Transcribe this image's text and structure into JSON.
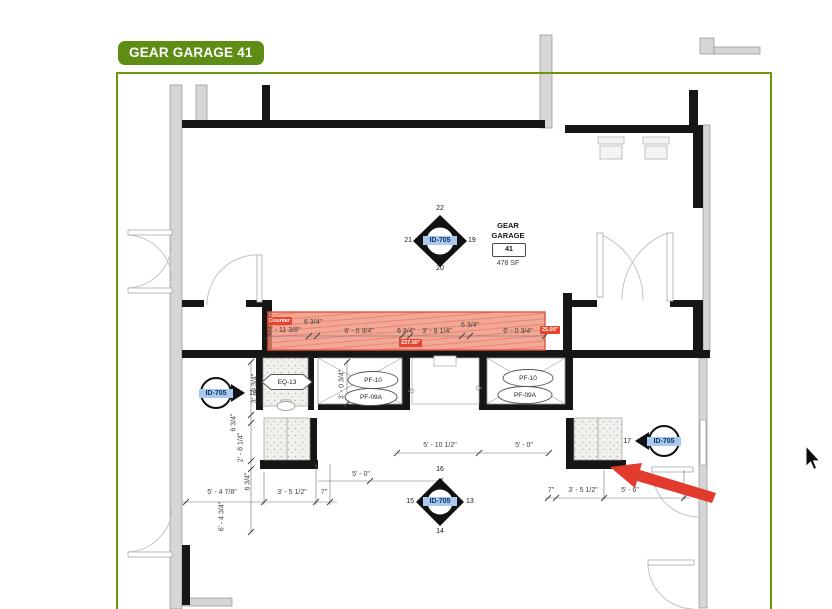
{
  "tag_label": "GEAR GARAGE 41",
  "room": {
    "name_line1": "GEAR",
    "name_line2": "GARAGE",
    "number": "41",
    "area": "478 SF"
  },
  "keynotes": {
    "center": {
      "id": "ID-705",
      "n_top": "22",
      "n_left": "21",
      "n_right": "19",
      "n_bottom": "20"
    },
    "bottom": {
      "id": "ID-705",
      "n_top": "16",
      "n_left": "15",
      "n_right": "13",
      "n_bottom": "14"
    },
    "left": {
      "id": "ID-705",
      "number": "18"
    },
    "right": {
      "id": "ID-705",
      "number": "17"
    }
  },
  "equipment_tags": {
    "eq": "EQ-13",
    "pf_left_top": "PF-10",
    "pf_left_bottom": "PF-09A",
    "pf_right_top": "PF-10",
    "pf_right_bottom": "PF-09A"
  },
  "counter": {
    "label": "Counter",
    "length_badge": "237.50\"",
    "width_badge": "25.00\"",
    "dims": [
      "6 3/4\"",
      "2' - 11 3/8\"",
      "6' - 0 3/4\"",
      "6 3/4\"",
      "3' - 8 1/4\"",
      "6 3/4\"",
      "6' - 0 3/4\""
    ]
  },
  "dimensions": {
    "mid_a": "5' - 10 1/2\"",
    "mid_b": "5' - 0\"",
    "mid_c": "5' - 0\"",
    "bl_a": "5' - 4 7/8\"",
    "bl_b": "3' - 5 1/2\"",
    "bl_c": "7\"",
    "br_a": "7\"",
    "br_b": "3' - 5 1/2\"",
    "br_c": "5' - 6\"",
    "v_a": "3' - 9 3/4\"",
    "v_b": "6 3/4\"",
    "v_c": "2' - 8 1/4\"",
    "v_d": "6 3/4\"",
    "v_e": "6' - 4 3/4\"",
    "v_f": "3' - 0 3/4\""
  },
  "colors": {
    "annotation_green": "#69990e",
    "tag_green": "#5d8d15",
    "counter_fill": "#ef8e76",
    "counter_border": "#e0563c",
    "badge_red": "#e8432d",
    "arrow_red": "#e23b2e",
    "id_highlight_blue": "#a9c9ee"
  }
}
